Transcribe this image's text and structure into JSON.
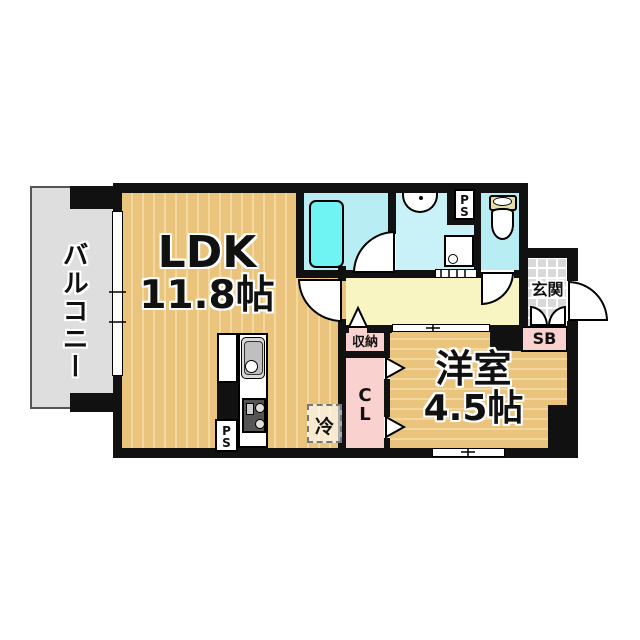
{
  "rooms": {
    "balcony": {
      "label": "バルコニー"
    },
    "ldk": {
      "label": "LDK",
      "size": "11.8帖"
    },
    "western_room": {
      "label": "洋室",
      "size": "4.5帖"
    },
    "entrance": {
      "label": "玄関"
    },
    "storage": {
      "label": "収納"
    },
    "closet": {
      "label": "CL"
    },
    "shoe_box": {
      "label": "SB"
    },
    "refrigerator": {
      "label": "冷"
    },
    "pipe_space_kitchen": {
      "label": "PS"
    },
    "pipe_space_toilet": {
      "label": "PS"
    }
  },
  "colors": {
    "wall": "#111111",
    "wood_floor": "#EAC47C",
    "wood_stripe": "#F2D89E",
    "hallway_floor": "#F9F5C2",
    "wet_area_cyan": "#B9EDF4",
    "bathtub_cyan": "#6FF3F3",
    "closet_pink": "#F9D2D0",
    "balcony_gray": "#DEDEDE",
    "entrance_tile_gray": "#D9D9D9"
  }
}
